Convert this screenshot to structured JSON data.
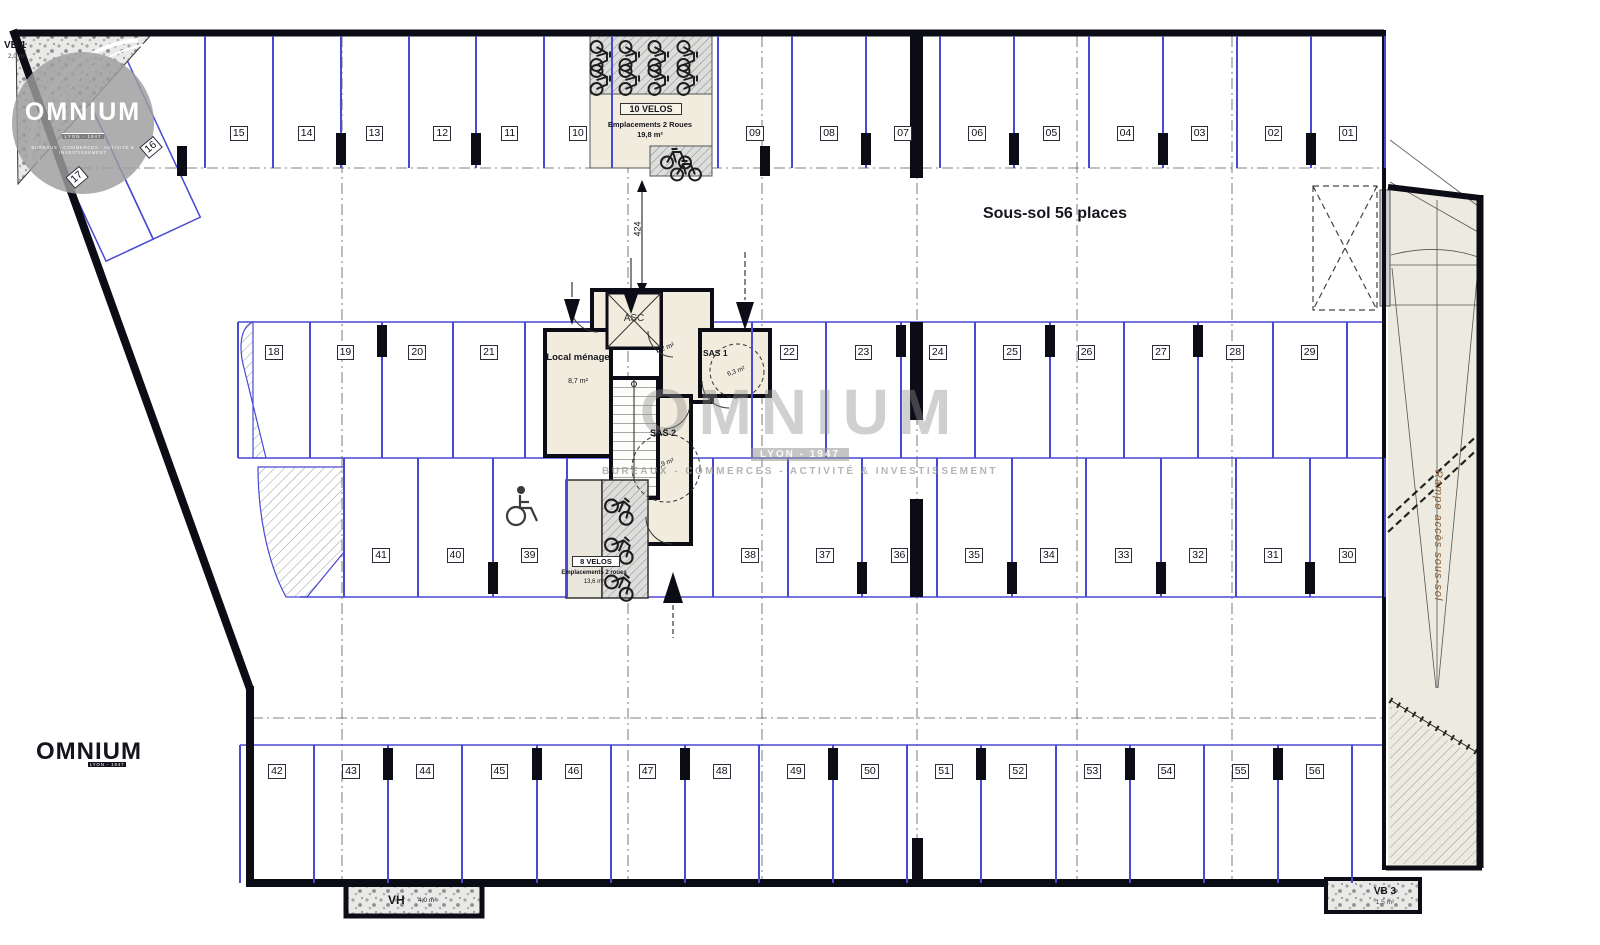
{
  "plan": {
    "title": "Sous-sol 56 places",
    "dimension_label": "424",
    "ramp_label": "Rampe accès sous-sol",
    "icons": {
      "accessible": "wheelchair-symbol",
      "bikes": "bicycle-symbol"
    }
  },
  "core": {
    "local_menage": {
      "name": "Local ménage",
      "area": "8,7 m²"
    },
    "elevator": {
      "name": "ASC"
    },
    "lobby": {
      "area": "7,2 m²"
    },
    "sas1": {
      "name": "SAS 1",
      "area": "6,3 m²"
    },
    "sas2": {
      "name": "SAS 2",
      "area": "7,9 m²"
    }
  },
  "bike_rooms": {
    "top": {
      "name": "10 VELOS",
      "desc": "Emplacements 2 Roues",
      "area": "19,8 m²"
    },
    "middle": {
      "name": "8 VELOS",
      "desc": "Emplacements 2 roues",
      "area": "13,6 m²"
    }
  },
  "vents": {
    "vb1": {
      "name": "VB 1",
      "area": "2,0 m²"
    },
    "vb3": {
      "name": "VB 3",
      "area": "1,5 m²"
    },
    "vh": {
      "name": "VH",
      "area": "4,0 m²"
    }
  },
  "branding": {
    "logo_text": "OMNIUM",
    "logo_badge": "LYON - 1947",
    "logo_subtitle": "BUREAUX - COMMERCES - ACTIVITÉ & INVESTISSEMENT"
  },
  "parking": {
    "row_top_left": [
      "15",
      "14",
      "13",
      "12",
      "11",
      "10"
    ],
    "row_top_right": [
      "09",
      "08",
      "07",
      "06",
      "05",
      "04",
      "03",
      "02",
      "01"
    ],
    "angled": [
      "16",
      "17"
    ],
    "row_mid1_left": [
      "18",
      "19",
      "20",
      "21"
    ],
    "row_mid1_right": [
      "22",
      "23",
      "24",
      "25",
      "26",
      "27",
      "28",
      "29"
    ],
    "row_mid2_left": [
      "41",
      "40",
      "39"
    ],
    "row_mid2_right": [
      "38",
      "37",
      "36",
      "35",
      "34",
      "33",
      "32",
      "31",
      "30"
    ],
    "row_bottom": [
      "42",
      "43",
      "44",
      "45",
      "46",
      "47",
      "48",
      "49",
      "50",
      "51",
      "52",
      "53",
      "54",
      "55",
      "56"
    ]
  },
  "colors": {
    "stall_line": "#4949d4",
    "wall": "#0c0c16",
    "room_fill": "#f1ecdd",
    "watermark": "#8e8e8e"
  }
}
